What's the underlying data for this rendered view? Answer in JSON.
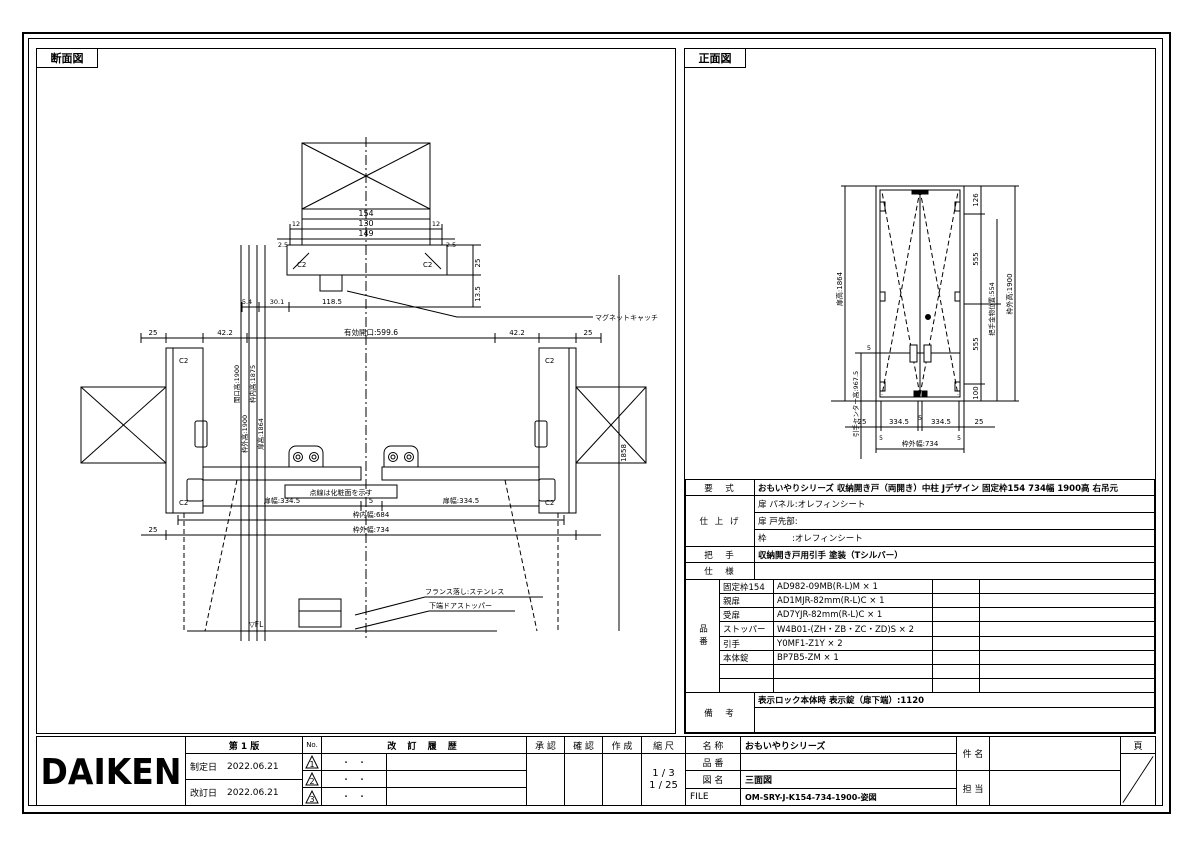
{
  "panels": {
    "section_title": "断面図",
    "front_title": "正面図"
  },
  "section_view": {
    "top_dims": {
      "d154": "154",
      "d130": "130",
      "d149": "149",
      "d12_left": "12",
      "d12_right": "12",
      "d2_5_left": "2.5",
      "d2_5_right": "2.5",
      "d25": "25",
      "d13_5": "13.5",
      "d5_4": "5.4",
      "d30_1": "30.1",
      "d118_5": "118.5"
    },
    "magnet_label": "マグネットキャッチ",
    "c2": "C2",
    "mid_dims": {
      "d25_left": "25",
      "d42_2_left": "42.2",
      "opening": "有効開口:599.6",
      "d42_2_right": "42.2",
      "d25_right": "25"
    },
    "vert_dims": {
      "v1": "開口高:1900",
      "v2": "枠外高:1900",
      "v3": "枠内高:1875",
      "v4": "扉高:1864",
      "v5": "1858"
    },
    "bottom_dims": {
      "leaf_left": "扉幅:334.5",
      "gap": "5",
      "leaf_right": "扉幅:334.5",
      "inner": "枠内幅:684",
      "outer": "枠外幅:734",
      "d25": "25"
    },
    "notes": {
      "dotted": "点線は化粧面を示す",
      "france": "フランス落し:ステンレス",
      "stopper": "下端ドアストッパー",
      "fl": "▽FL"
    }
  },
  "front_view": {
    "left_dims": {
      "door_h": "扉高:1864",
      "handle_h": "引手センター高:967.5",
      "d5": "5"
    },
    "right_dims": {
      "d126": "126",
      "d555_top": "555",
      "d554": "把手金物位置:554",
      "d555_bottom": "555",
      "d100": "100",
      "outer_h": "枠外高:1900"
    },
    "bottom_dims": {
      "d25_left": "25",
      "d334_left": "334.5",
      "d5": "5",
      "d334_right": "334.5",
      "d25_right": "25",
      "d5a": "5",
      "d5b": "5",
      "outer_w": "枠外幅:734"
    }
  },
  "spec_table": {
    "model": {
      "label": "要　式",
      "value": "おもいやりシリーズ 収納開き戸（両開き）中柱 Jデザイン 固定枠154 734幅 1900高 右吊元"
    },
    "finish": {
      "label": "仕 上 げ",
      "rows": [
        {
          "text": "扉 パネル:オレフィンシート"
        },
        {
          "text": "扉 戸先部:"
        },
        {
          "text": "枠　　　:オレフィンシート"
        }
      ]
    },
    "handle": {
      "label": "把　手",
      "value": "収納開き戸用引手 塗装（Tシルバー）"
    },
    "spec": {
      "label": "仕　様",
      "value": ""
    },
    "parts": {
      "label": "品番",
      "rows": [
        {
          "name": "固定枠154",
          "value": "AD982-09MB(R-L)M × 1",
          "qty": "",
          "note": ""
        },
        {
          "name": "親扉",
          "value": "AD1MJR-82mm(R-L)C × 1",
          "qty": "",
          "note": ""
        },
        {
          "name": "受扉",
          "value": "AD7YJR-82mm(R-L)C × 1",
          "qty": "",
          "note": ""
        },
        {
          "name": "ストッパー",
          "value": "W4B01-(ZH・ZB・ZC・ZD)S × 2",
          "qty": "",
          "note": ""
        },
        {
          "name": "引手",
          "value": "Y0MF1-Z1Y × 2",
          "qty": "",
          "note": ""
        },
        {
          "name": "本体錠",
          "value": "BP7B5-ZM × 1",
          "qty": "",
          "note": ""
        },
        {
          "name": "",
          "value": "",
          "qty": "",
          "note": ""
        },
        {
          "name": "",
          "value": "",
          "qty": "",
          "note": ""
        }
      ]
    },
    "remarks": {
      "label": "備　考",
      "note": "表示ロック本体時 表示錠（扉下端）:1120"
    }
  },
  "title_block": {
    "logo": "DAIKEN",
    "edition": "第 1 版",
    "established_label": "制定日",
    "established_date": "2022.06.21",
    "revised_label": "改訂日",
    "revised_date": "2022.06.21",
    "no_label": "No.",
    "history_label": "改 訂 履 歴",
    "history_rows": [
      {
        "mark": "1",
        "date": "・　・"
      },
      {
        "mark": "2",
        "date": "・　・"
      },
      {
        "mark": "3",
        "date": "・　・"
      }
    ],
    "approved_label": "承 認",
    "checked_label": "確 認",
    "created_label": "作 成",
    "scale_label": "縮 尺",
    "scale_values": [
      "1 / 3",
      "1 / 25"
    ],
    "name_label": "名 称",
    "name_value": "おもいやりシリーズ",
    "part_label": "品 番",
    "part_value": "",
    "drawing_label": "図 名",
    "drawing_value": "三面図",
    "file_label": "FILE",
    "file_value": "OM-SRY-J-K154-734-1900-姿図",
    "subject_label": "件 名",
    "person_label": "担 当",
    "page_label": "頁"
  }
}
